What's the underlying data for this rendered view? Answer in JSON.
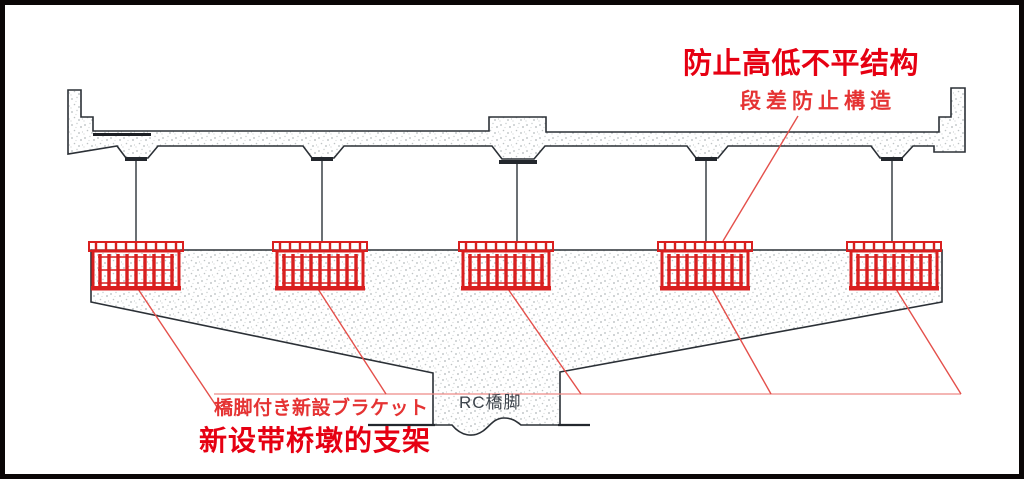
{
  "diagram": {
    "type": "bridge-pier-elevation",
    "title_cn": "防止高低不平结构",
    "subtitle_jp": "段差防止構造",
    "bracket_label_jp": "橋脚付き新設ブラケット",
    "bracket_label_cn": "新设带桥墩的支架",
    "pier_label": "RC橋脚",
    "bracket_count": 5
  },
  "colors": {
    "accent_red": "#e60012",
    "annotation_red": "#e53333",
    "bracket_red": "#d91f1f",
    "leader_red": "#e4504b",
    "reference_line_red": "#ee8a86",
    "drawing_line_dark": "#2b3036",
    "stipple_gray": "#b6bcbe",
    "frame_black": "#0a0606"
  }
}
